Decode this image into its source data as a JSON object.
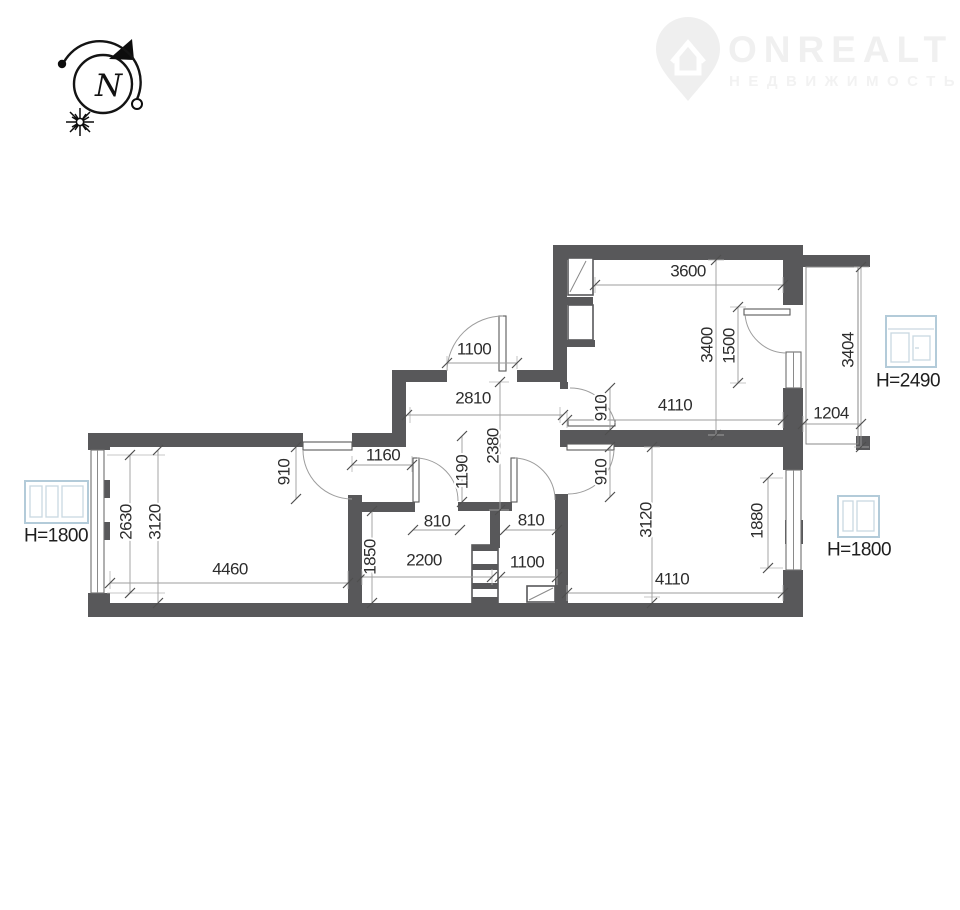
{
  "watermark": {
    "brand": "ONREALT",
    "subtitle": "НЕДВИЖИМОСТЬ"
  },
  "compass": {
    "letter": "N"
  },
  "window_labels": {
    "balcony_door": "H=2490",
    "left_window": "H=1800",
    "right_window": "H=1800"
  },
  "dims": {
    "left_room": {
      "window_width": "2630",
      "width": "3120",
      "length": "4460",
      "door": "910",
      "niche": "1160"
    },
    "hall": {
      "entry_door": "1100",
      "length": "2810",
      "width": "2380",
      "depth": "1190"
    },
    "bathroom": {
      "width": "1850",
      "length": "2200",
      "door": "810"
    },
    "toilet": {
      "door": "810",
      "width": "1100"
    },
    "kitchen": {
      "top_length": "3600",
      "width": "3400",
      "door_zone": "1500",
      "door": "910",
      "length": "4110"
    },
    "balcony": {
      "width": "1204",
      "length": "3404"
    },
    "bedroom": {
      "door": "910",
      "width": "3120",
      "window": "1880",
      "length": "4110"
    }
  }
}
